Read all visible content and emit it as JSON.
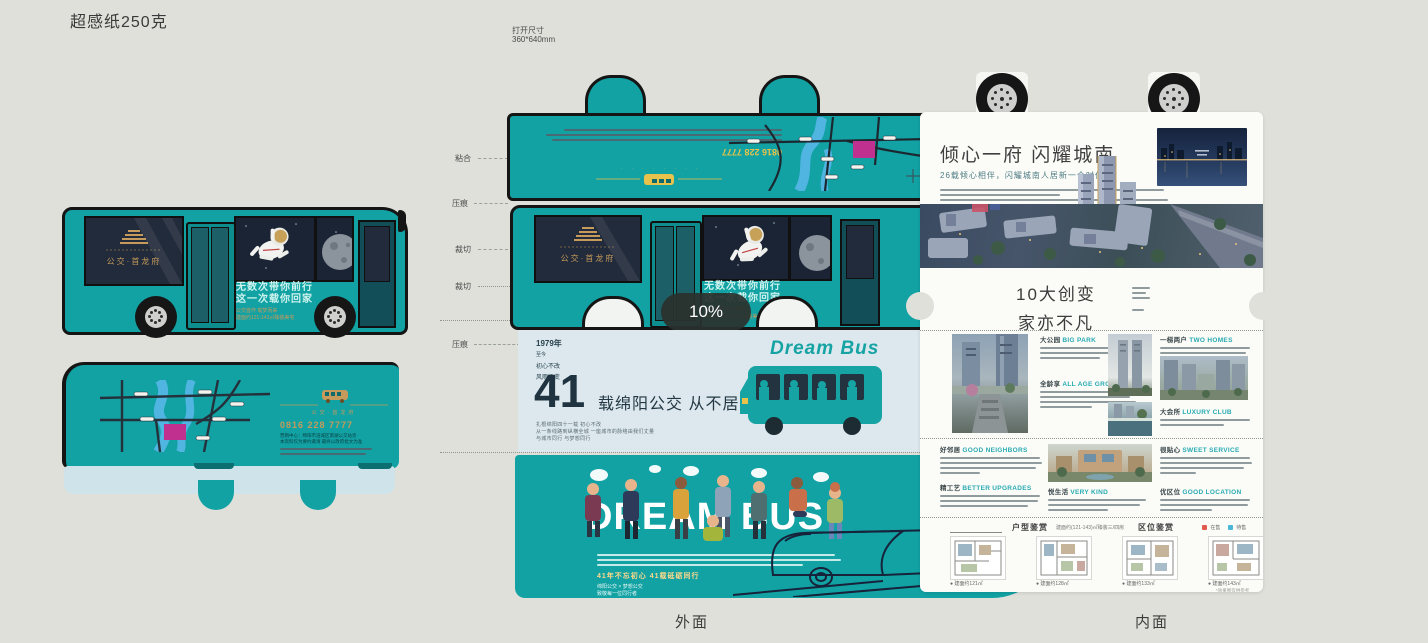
{
  "header": {
    "paper_spec": "超感纸250克",
    "open_size_label": "打开尺寸",
    "open_size_value": "360*640mm"
  },
  "captions": {
    "outer": "外面",
    "inner": "内面"
  },
  "zoom_indicator": {
    "value": "10%"
  },
  "marks": {
    "m1": "粘合",
    "m2": "压痕",
    "m3": "裁切",
    "m4": "裁切",
    "m5": "压痕"
  },
  "bus_art": {
    "window_logo": "公交·首龙府",
    "slogan_line1": "无数次带你前行",
    "slogan_line2": "这一次载你回家",
    "gold_line1": "公交首作 载梦而来",
    "gold_line2": "建面约121-143㎡臻装美宅"
  },
  "back_art": {
    "brand": "公交·首龙府",
    "phone": "0816 228 7777",
    "note1": "营销中心：绵阳市涪城区南湖公交站旁",
    "note2": "本资料仅为要约邀请 最终以政府批文为准"
  },
  "outer_panel": {
    "flap_phone": "0816 228 7777",
    "stats": {
      "year": "1979年",
      "l1": "至今",
      "l2": "初心不改",
      "l3": "风雨不变",
      "big": "41",
      "headline": "载绵阳公交  从不居功自骄",
      "p1": "扎根绵阳四十一载 初心不改",
      "p2": "从一条线路到纵横全城 一座城市的脉络由我们丈量",
      "p3": "与城市同行 与梦想同行"
    },
    "dream_logo": "Dream Bus",
    "bottom": {
      "title": "DREAM BUS",
      "gold": "41年不忘初心 41载砥砺同行",
      "s1": "绵阳公交 × 梦想公交",
      "s2": "致敬每一位同行者"
    }
  },
  "inner_panel": {
    "headline": "倾心一府 闪耀城南",
    "subtitle": "26载倾心相伴，闪耀城南人居新一个时代",
    "sec2_line1": "10大创变",
    "sec2_line2": "家亦不凡",
    "grid": {
      "g1": {
        "zh": "大公园",
        "en": "BIG PARK"
      },
      "g2": {
        "zh": "全龄享",
        "en": "ALL AGE GROUPS"
      },
      "g3": {
        "zh": "一梯两户",
        "en": "TWO HOMES"
      },
      "g4": {
        "zh": "大会所",
        "en": "LUXURY CLUB"
      },
      "g5": {
        "zh": "好邻居",
        "en": "GOOD NEIGHBORS"
      },
      "g6": {
        "zh": "精工艺",
        "en": "BETTER UPGRADES"
      },
      "g7": {
        "zh": "悦生活",
        "en": "VERY KIND"
      },
      "g8": {
        "zh": "很贴心",
        "en": "SWEET SERVICE"
      },
      "g9": {
        "zh": "优区位",
        "en": "GOOD LOCATION"
      }
    },
    "plans": {
      "header": "户型鉴赏",
      "note": "建面约(121-143)㎡臻装三/四房",
      "header2": "区位鉴赏",
      "legend1": "在售",
      "legend2": "待售",
      "c1": "建面约121㎡",
      "c2": "建面约128㎡",
      "c3": "建面约133㎡",
      "c4": "建面约143㎡",
      "disclaimer": "*效果图仅供参考"
    }
  }
}
